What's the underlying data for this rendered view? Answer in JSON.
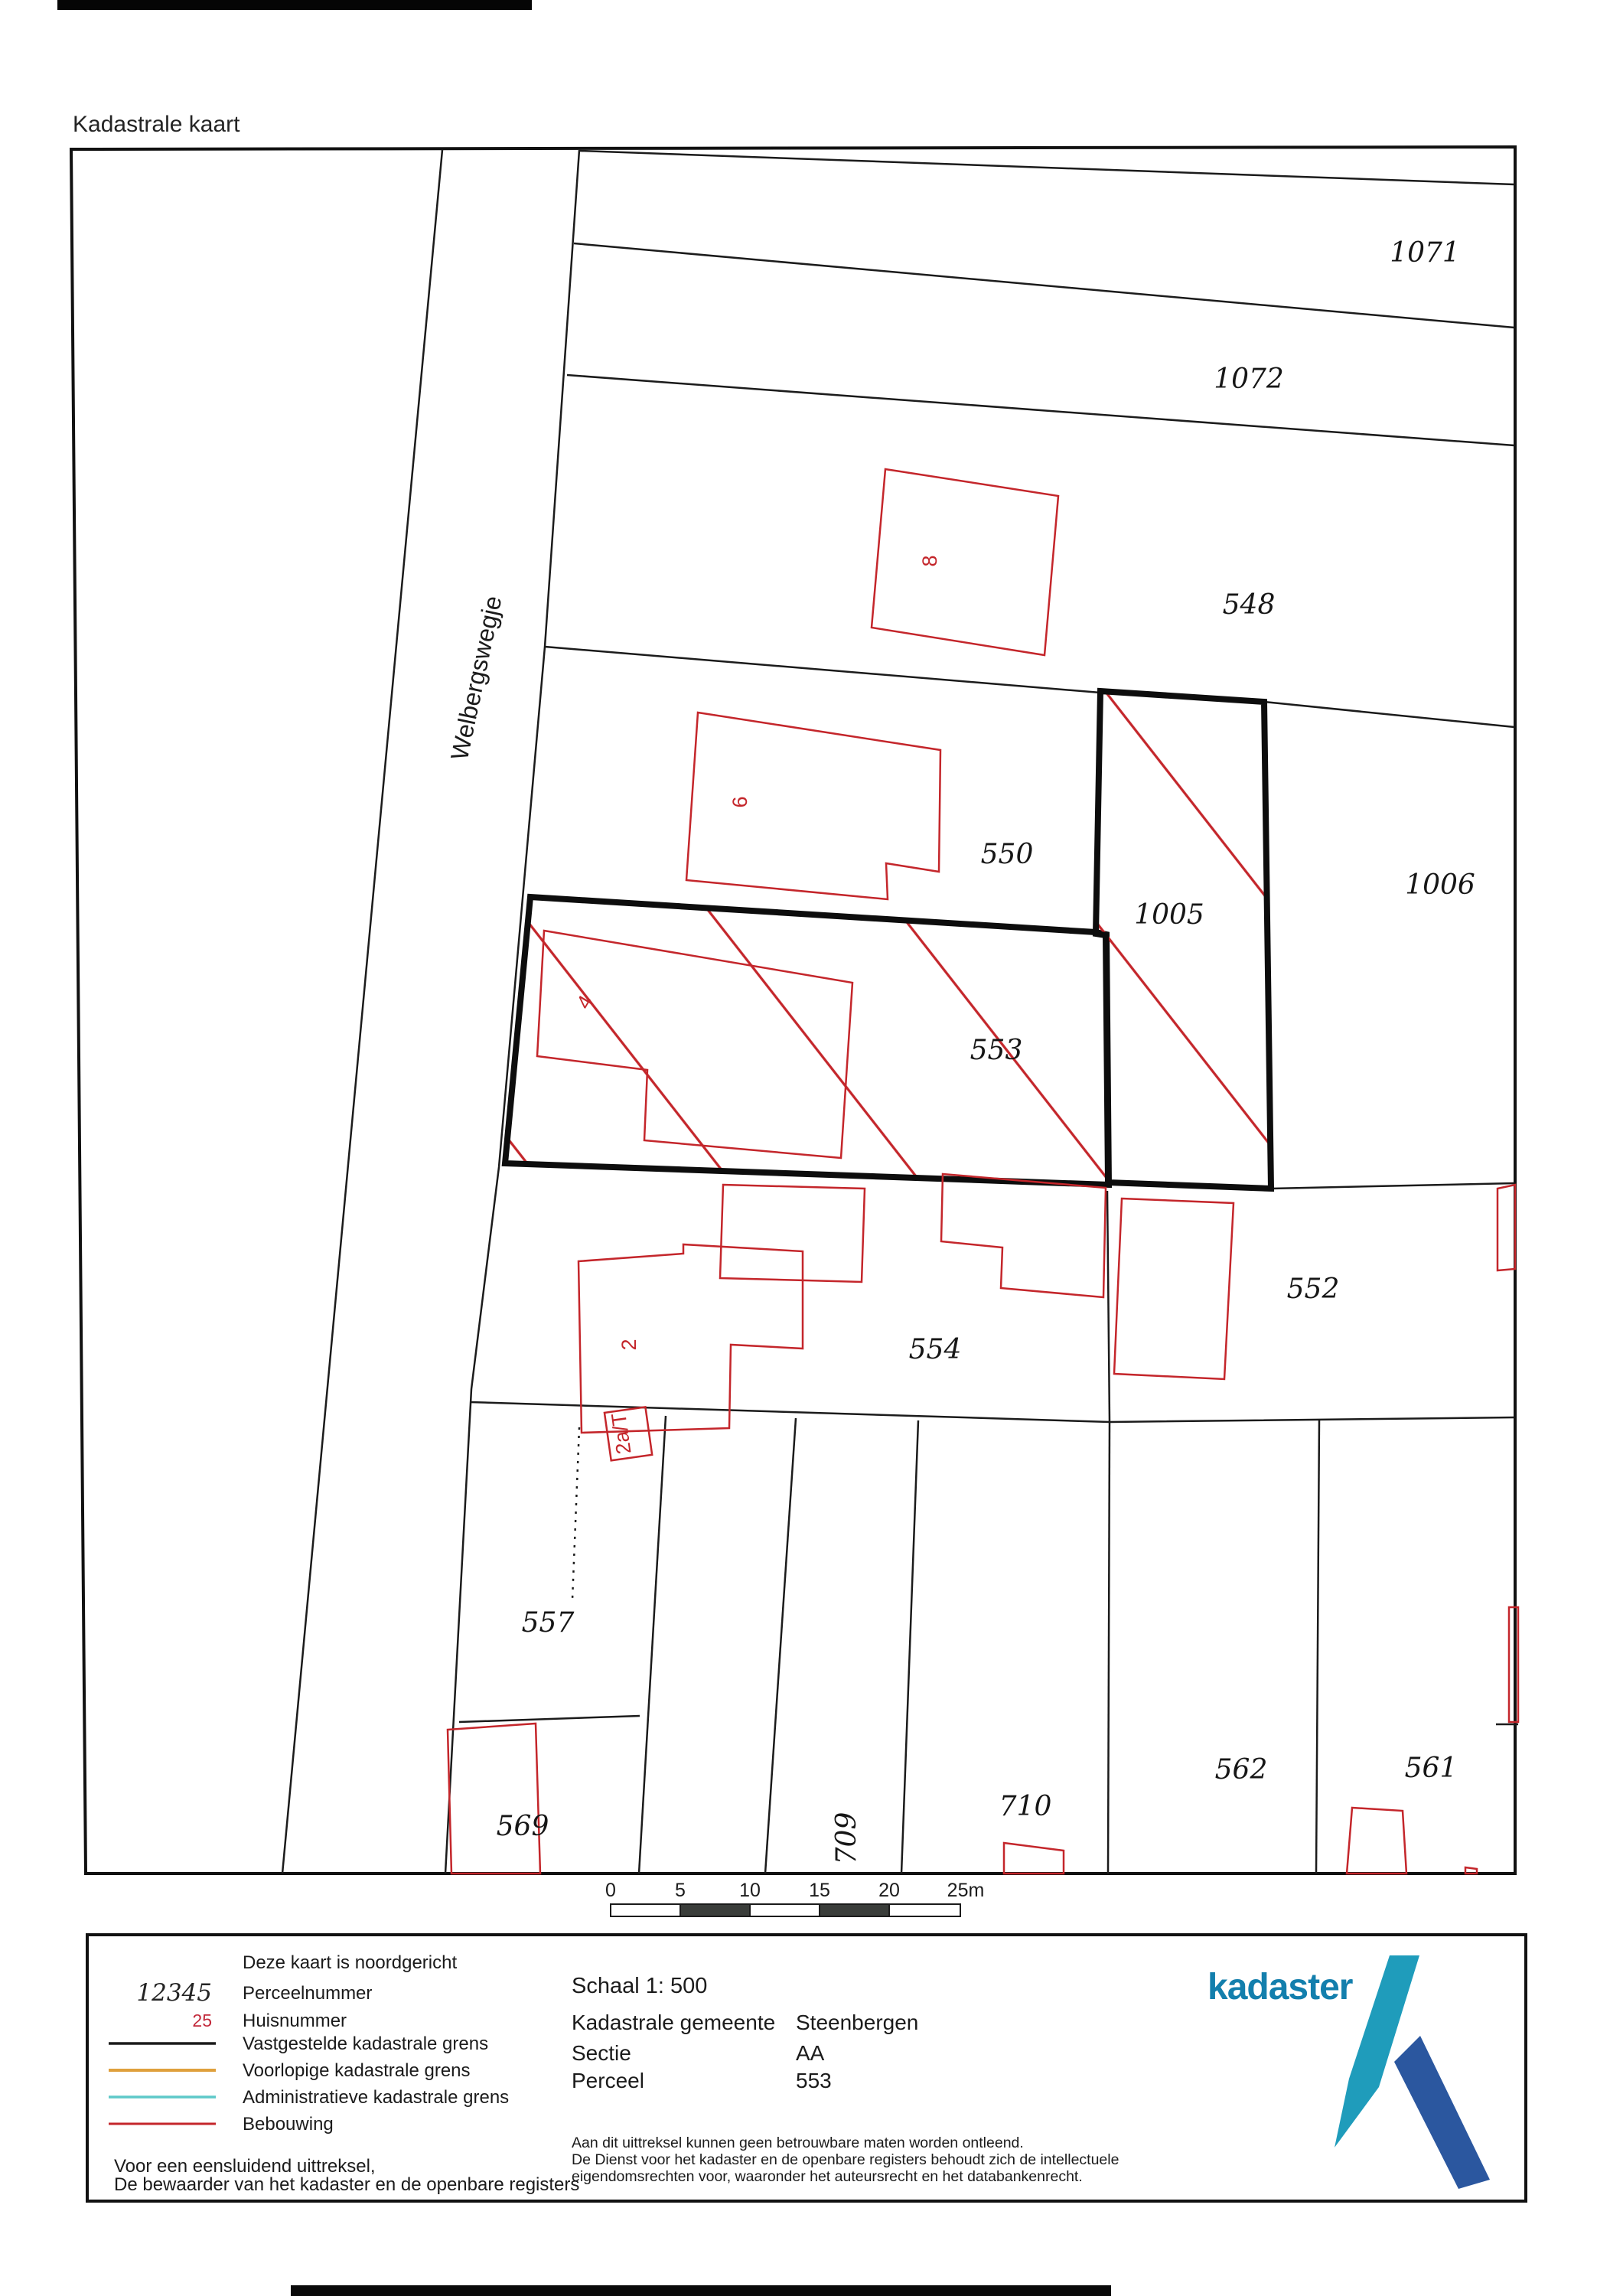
{
  "page": {
    "title": "Kadastrale kaart"
  },
  "map": {
    "street": "Welbergswegje",
    "parcels": {
      "p1071": "1071",
      "p1072": "1072",
      "p548": "548",
      "p550": "550",
      "p1005": "1005",
      "p1006": "1006",
      "p553": "553",
      "p554": "554",
      "p552": "552",
      "p557": "557",
      "p569": "569",
      "p709": "709",
      "p710": "710",
      "p562": "562",
      "p561": "561"
    },
    "house_numbers": {
      "h8": "8",
      "h6": "6",
      "h4": "4",
      "h2": "2",
      "h2a": "2a/T"
    }
  },
  "scalebar": {
    "ticks": [
      "0",
      "5",
      "10",
      "15",
      "20",
      "25m"
    ]
  },
  "legend": {
    "north_note": "Deze kaart is noordgericht",
    "items": [
      {
        "sample": "12345",
        "label": "Perceelnummer"
      },
      {
        "sample": "25",
        "label": "Huisnummer"
      },
      {
        "label": "Vastgestelde kadastrale grens"
      },
      {
        "label": "Voorlopige kadastrale grens"
      },
      {
        "label": "Administratieve kadastrale grens"
      },
      {
        "label": "Bebouwing"
      }
    ],
    "attestation_line1": "Voor een eensluidend uittreksel,",
    "attestation_line2": "De bewaarder van het kadaster en de openbare registers"
  },
  "details": {
    "scale_label": "Schaal 1: 500",
    "rows": [
      {
        "label": "Kadastrale gemeente",
        "value": "Steenbergen"
      },
      {
        "label": "Sectie",
        "value": "AA"
      },
      {
        "label": "Perceel",
        "value": "553"
      }
    ],
    "disclaimer": [
      "Aan dit uittreksel kunnen geen betrouwbare maten worden ontleend.",
      "De Dienst voor het kadaster en de openbare registers behoudt zich de intellectuele",
      "eigendomsrechten voor, waaronder het auteursrecht en het databankenrecht."
    ]
  },
  "logo": {
    "wordmark": "kadaster"
  },
  "colors": {
    "building_red": "#c4262b",
    "boundary_black": "#1b1b1b",
    "selected_parcel_hatch_red": "#c4262b",
    "provisional_orange": "#dfa03c",
    "administrative_cyan": "#5ec9c9",
    "housenumber_red": "#c2283a",
    "logo_text_blue": "#137fad",
    "logo_teal": "#1f9cbb",
    "logo_dark_blue": "#2b579f"
  }
}
